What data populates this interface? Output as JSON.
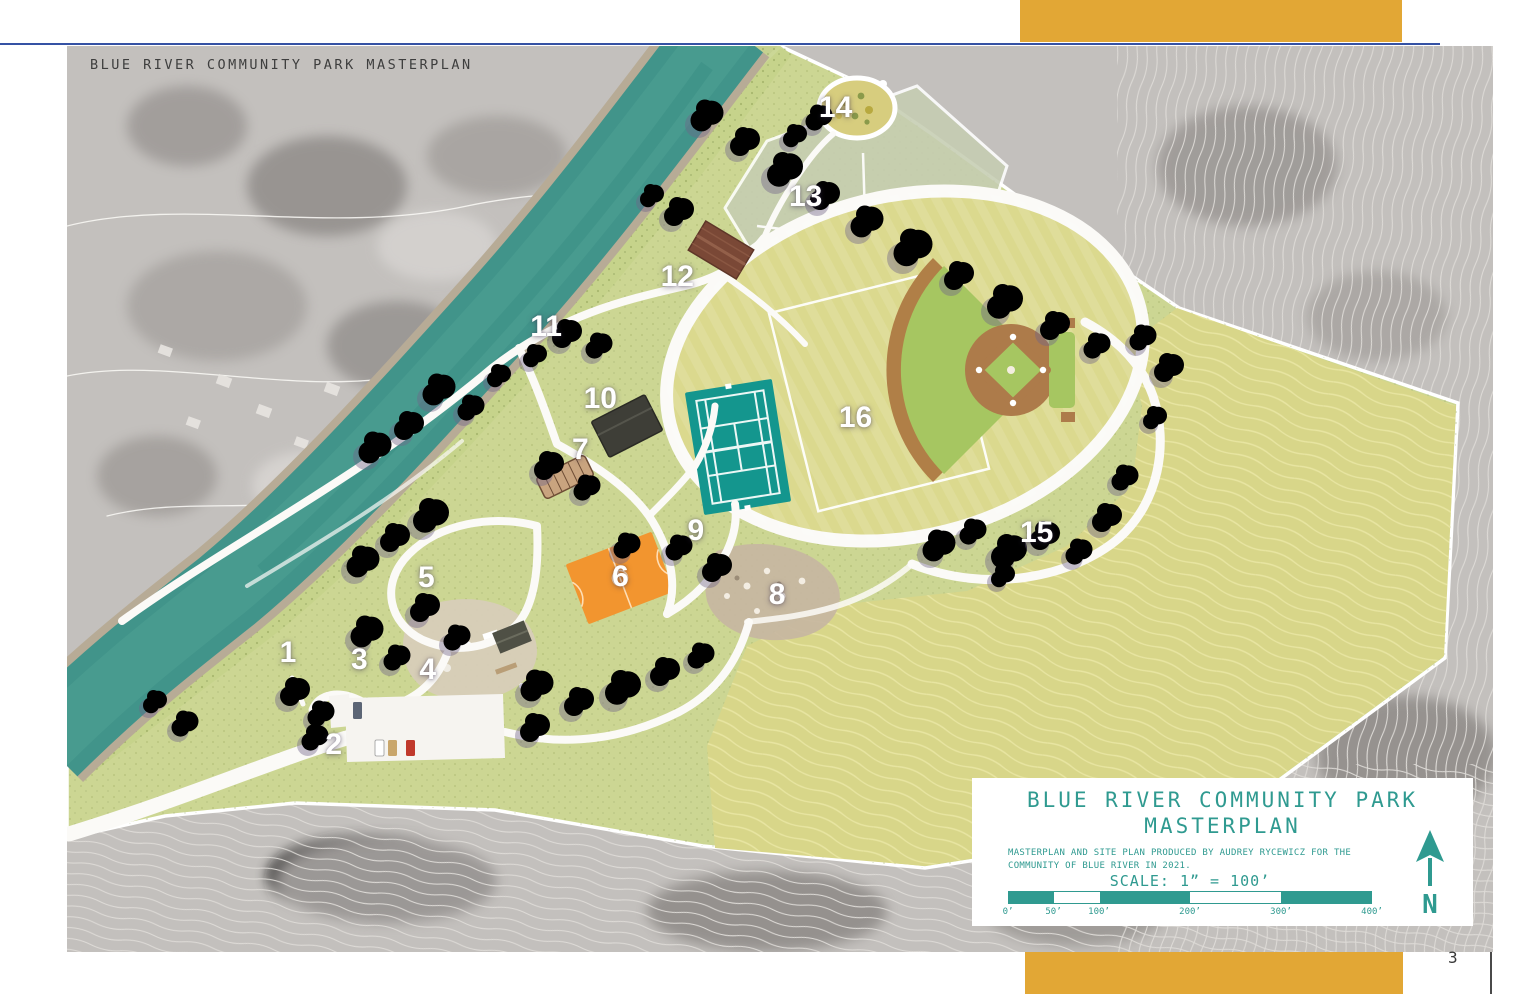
{
  "page": {
    "number": "3"
  },
  "header": {
    "title": "BLUE RIVER COMMUNITY PARK MASTERPLAN"
  },
  "accent_colors": {
    "teal": "#2F9A90",
    "gold": "#E2A735",
    "blue_rule": "#3552A4"
  },
  "map": {
    "labels": [
      {
        "n": "1",
        "x": 15.5,
        "y": 67.0
      },
      {
        "n": "2",
        "x": 18.7,
        "y": 77.2
      },
      {
        "n": "3",
        "x": 20.5,
        "y": 67.8
      },
      {
        "n": "4",
        "x": 25.3,
        "y": 68.9
      },
      {
        "n": "5",
        "x": 25.2,
        "y": 58.7
      },
      {
        "n": "6",
        "x": 38.8,
        "y": 58.6
      },
      {
        "n": "7",
        "x": 36.0,
        "y": 44.6
      },
      {
        "n": "8",
        "x": 49.8,
        "y": 60.6
      },
      {
        "n": "9",
        "x": 44.1,
        "y": 53.5
      },
      {
        "n": "10",
        "x": 37.4,
        "y": 39.0
      },
      {
        "n": "11",
        "x": 33.6,
        "y": 31.0
      },
      {
        "n": "12",
        "x": 42.8,
        "y": 25.5
      },
      {
        "n": "13",
        "x": 51.8,
        "y": 16.7
      },
      {
        "n": "14",
        "x": 53.9,
        "y": 6.8
      },
      {
        "n": "15",
        "x": 68.0,
        "y": 53.7
      },
      {
        "n": "16",
        "x": 55.3,
        "y": 41.1
      }
    ]
  },
  "title_block": {
    "title_line1": "BLUE RIVER COMMUNITY PARK",
    "title_line2": "MASTERPLAN",
    "credit": "MASTERPLAN AND SITE PLAN PRODUCED BY AUDREY RYCEWICZ FOR THE COMMUNITY OF BLUE RIVER IN 2021.",
    "scale_label": "SCALE: 1” = 100’",
    "scale_ticks": [
      "0’",
      "50’",
      "100’",
      "200’",
      "300’",
      "400’"
    ],
    "north_label": "N"
  }
}
